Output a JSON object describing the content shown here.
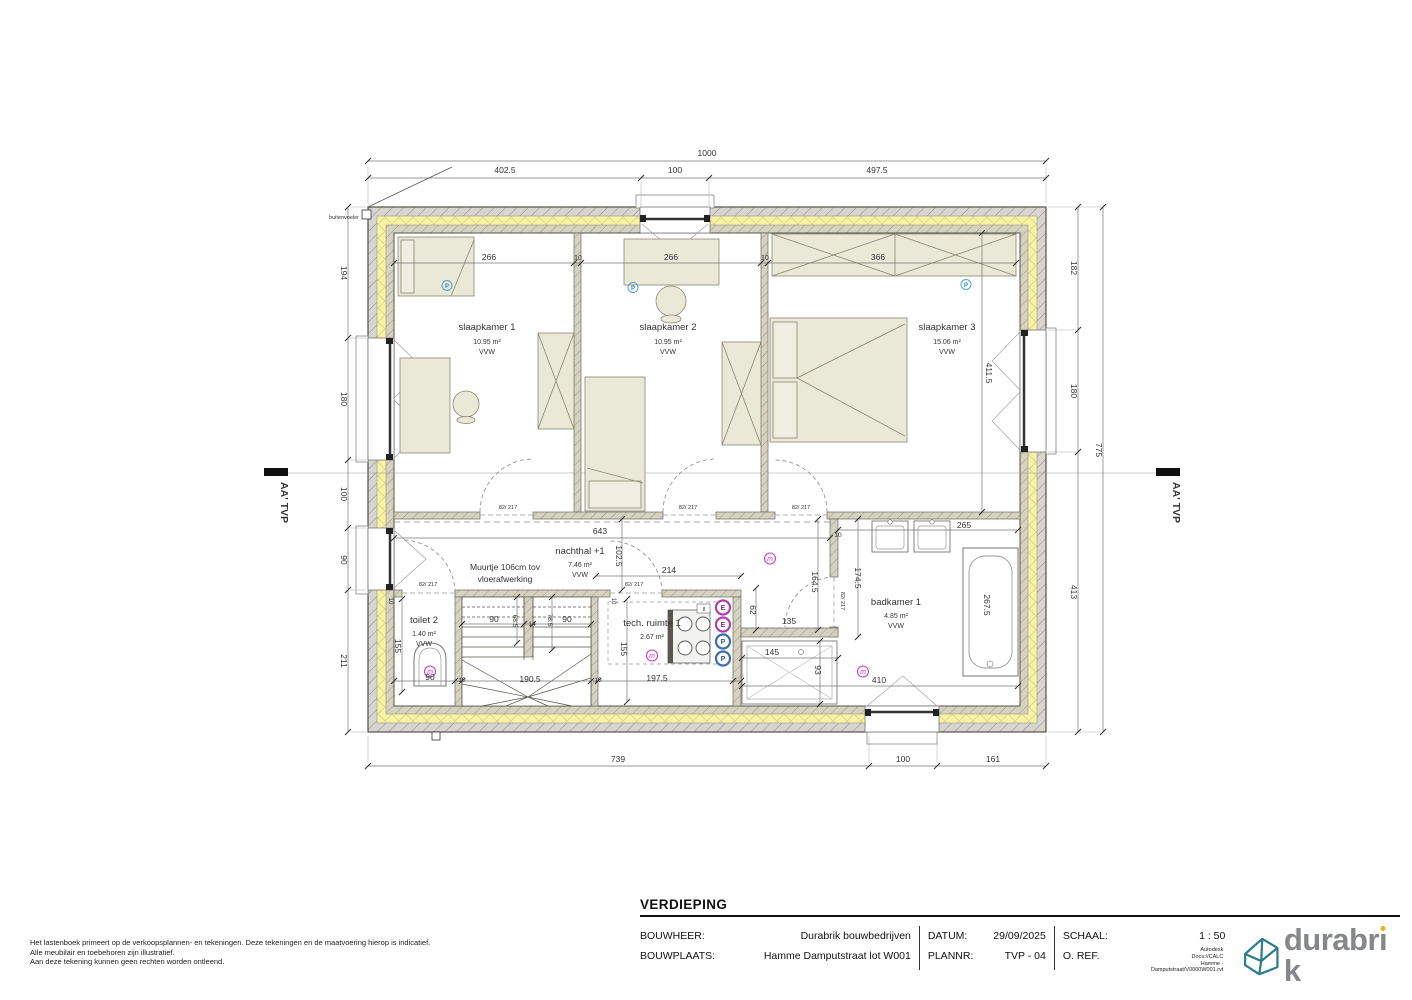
{
  "plan": {
    "labels": [
      {
        "t": "1000",
        "x": 707,
        "y": 156
      },
      {
        "t": "402.5",
        "x": 505,
        "y": 173
      },
      {
        "t": "100",
        "x": 675,
        "y": 173
      },
      {
        "t": "497.5",
        "x": 877,
        "y": 173
      },
      {
        "t": "194",
        "x": 341,
        "y": 273,
        "r": 90
      },
      {
        "t": "180",
        "x": 341,
        "y": 399,
        "r": 90
      },
      {
        "t": "100",
        "x": 341,
        "y": 494,
        "r": 90
      },
      {
        "t": "90",
        "x": 341,
        "y": 560,
        "r": 90
      },
      {
        "t": "211",
        "x": 341,
        "y": 661,
        "r": 90
      },
      {
        "t": "182",
        "x": 1071,
        "y": 268,
        "r": 90
      },
      {
        "t": "180",
        "x": 1071,
        "y": 391,
        "r": 90
      },
      {
        "t": "413",
        "x": 1071,
        "y": 592,
        "r": 90
      },
      {
        "t": "775",
        "x": 1096,
        "y": 450,
        "r": 90
      },
      {
        "t": "739",
        "x": 618,
        "y": 762
      },
      {
        "t": "100",
        "x": 903,
        "y": 762
      },
      {
        "t": "161",
        "x": 993,
        "y": 762
      },
      {
        "t": "buitenvoeler",
        "x": 359,
        "y": 219,
        "s": 5.5,
        "a": "end",
        "n": "sensor-label"
      },
      {
        "t": "266",
        "x": 489,
        "y": 260
      },
      {
        "t": "10",
        "x": 578,
        "y": 260,
        "s": 7
      },
      {
        "t": "266",
        "x": 671,
        "y": 260
      },
      {
        "t": "10",
        "x": 765,
        "y": 260,
        "s": 7
      },
      {
        "t": "366",
        "x": 878,
        "y": 260
      },
      {
        "t": "411.5",
        "x": 986,
        "y": 373,
        "r": 90
      },
      {
        "t": "643",
        "x": 600,
        "y": 534
      },
      {
        "t": "102.5",
        "x": 616,
        "y": 556,
        "r": 90
      },
      {
        "t": "214",
        "x": 669,
        "y": 573
      },
      {
        "t": "10",
        "x": 838,
        "y": 537,
        "s": 6.5
      },
      {
        "t": "174.5",
        "x": 855,
        "y": 578,
        "r": 90
      },
      {
        "t": "164.5",
        "x": 812,
        "y": 582,
        "r": 90
      },
      {
        "t": "62",
        "x": 750,
        "y": 610,
        "r": 90
      },
      {
        "t": "135",
        "x": 789,
        "y": 624
      },
      {
        "t": "145",
        "x": 772,
        "y": 655
      },
      {
        "t": "93",
        "x": 815,
        "y": 670,
        "r": 90
      },
      {
        "t": "410",
        "x": 879,
        "y": 683
      },
      {
        "t": "265",
        "x": 964,
        "y": 528
      },
      {
        "t": "267.5",
        "x": 984,
        "y": 605,
        "r": 90
      },
      {
        "t": "155",
        "x": 395,
        "y": 646,
        "r": 90
      },
      {
        "t": "90",
        "x": 430,
        "y": 680
      },
      {
        "t": "10",
        "x": 462,
        "y": 682,
        "s": 6.5
      },
      {
        "t": "190.5",
        "x": 530,
        "y": 682
      },
      {
        "t": "10",
        "x": 598,
        "y": 682,
        "s": 6.5
      },
      {
        "t": "197.5",
        "x": 657,
        "y": 681
      },
      {
        "t": "155",
        "x": 621,
        "y": 649,
        "r": 90
      },
      {
        "t": "90",
        "x": 494,
        "y": 622
      },
      {
        "t": "68.5",
        "x": 513,
        "y": 621,
        "r": 90,
        "s": 6.5
      },
      {
        "t": "14",
        "x": 532,
        "y": 626,
        "s": 6.5
      },
      {
        "t": "78.5",
        "x": 548,
        "y": 620,
        "r": 90,
        "s": 6.5
      },
      {
        "t": "90",
        "x": 567,
        "y": 622
      },
      {
        "t": "10",
        "x": 389,
        "y": 601,
        "r": 90,
        "s": 6
      },
      {
        "t": "10",
        "x": 612,
        "y": 601,
        "r": 90,
        "s": 6
      },
      {
        "t": "82/ 217",
        "x": 508,
        "y": 509,
        "s": 5.5,
        "n": "door-size-label"
      },
      {
        "t": "82/ 217",
        "x": 688,
        "y": 509,
        "s": 5.5,
        "n": "door-size-label"
      },
      {
        "t": "82/ 217",
        "x": 801,
        "y": 509,
        "s": 5.5,
        "n": "door-size-label"
      },
      {
        "t": "82/ 217",
        "x": 428,
        "y": 586,
        "s": 5.5,
        "n": "door-size-label"
      },
      {
        "t": "82/ 217",
        "x": 634,
        "y": 586,
        "s": 5.5,
        "n": "door-size-label"
      },
      {
        "t": "82/ 217",
        "x": 841,
        "y": 601,
        "r": 90,
        "s": 5.5,
        "n": "door-size-label"
      },
      {
        "t": "AA' TVP",
        "x": 281,
        "y": 482,
        "r": 90,
        "s": 10.5,
        "a": "start",
        "w": "bold",
        "n": "section-marker-label"
      },
      {
        "t": "AA' TVP",
        "x": 1173,
        "y": 482,
        "r": 90,
        "s": 10.5,
        "a": "start",
        "w": "bold",
        "n": "section-marker-label"
      },
      {
        "t": "slaapkamer 1",
        "x": 487,
        "y": 330,
        "s": 9.5,
        "n": "room-label"
      },
      {
        "t": "10.95 m²",
        "x": 487,
        "y": 344,
        "s": 7,
        "n": "room-area"
      },
      {
        "t": "VVW",
        "x": 487,
        "y": 354,
        "s": 7,
        "n": "room-floor"
      },
      {
        "t": "slaapkamer 2",
        "x": 668,
        "y": 330,
        "s": 9.5,
        "n": "room-label"
      },
      {
        "t": "10.95 m²",
        "x": 668,
        "y": 344,
        "s": 7,
        "n": "room-area"
      },
      {
        "t": "VVW",
        "x": 668,
        "y": 354,
        "s": 7,
        "n": "room-floor"
      },
      {
        "t": "slaapkamer 3",
        "x": 947,
        "y": 330,
        "s": 9.5,
        "n": "room-label"
      },
      {
        "t": "15.06 m²",
        "x": 947,
        "y": 344,
        "s": 7,
        "n": "room-area"
      },
      {
        "t": "VVW",
        "x": 947,
        "y": 354,
        "s": 7,
        "n": "room-floor"
      },
      {
        "t": "nachthal +1",
        "x": 580,
        "y": 554,
        "s": 9.5,
        "n": "room-label"
      },
      {
        "t": "7.46 m²",
        "x": 580,
        "y": 567,
        "s": 7,
        "n": "room-area"
      },
      {
        "t": "VVW",
        "x": 580,
        "y": 577,
        "s": 7,
        "n": "room-floor"
      },
      {
        "t": "Muurtje 106cm tov",
        "x": 505,
        "y": 570,
        "s": 8.5,
        "n": "note-label"
      },
      {
        "t": "vloerafwerking",
        "x": 505,
        "y": 582,
        "s": 8.5,
        "n": "note-label"
      },
      {
        "t": "toilet 2",
        "x": 424,
        "y": 623,
        "s": 9.5,
        "n": "room-label"
      },
      {
        "t": "1.40 m²",
        "x": 424,
        "y": 636,
        "s": 7,
        "n": "room-area"
      },
      {
        "t": "VVW",
        "x": 424,
        "y": 646,
        "s": 7,
        "n": "room-floor"
      },
      {
        "t": "tech. ruimte 1",
        "x": 652,
        "y": 626,
        "s": 9.5,
        "n": "room-label"
      },
      {
        "t": "2.67 m²",
        "x": 652,
        "y": 639,
        "s": 7,
        "n": "room-area"
      },
      {
        "t": "badkamer 1",
        "x": 896,
        "y": 605,
        "s": 9.5,
        "n": "room-label"
      },
      {
        "t": "4.85 m²",
        "x": 896,
        "y": 618,
        "s": 7,
        "n": "room-area"
      },
      {
        "t": "VVW",
        "x": 896,
        "y": 628,
        "s": 7,
        "n": "room-floor"
      },
      {
        "t": "m",
        "x": 430,
        "y": 674,
        "s": 7,
        "c": "#cf3ccf",
        "i": true,
        "n": "switch-symbol-letter"
      },
      {
        "t": "m",
        "x": 652,
        "y": 658,
        "s": 7,
        "c": "#cf3ccf",
        "i": true,
        "n": "switch-symbol-letter"
      },
      {
        "t": "m",
        "x": 770,
        "y": 561,
        "s": 7,
        "c": "#cf3ccf",
        "i": true,
        "n": "switch-symbol-letter"
      },
      {
        "t": "m",
        "x": 863,
        "y": 674,
        "s": 7,
        "c": "#cf3ccf",
        "i": true,
        "n": "switch-symbol-letter"
      },
      {
        "t": "P",
        "x": 447,
        "y": 288,
        "s": 6,
        "c": "#2e86c8",
        "w": "bold",
        "n": "outlet-symbol-letter"
      },
      {
        "t": "P",
        "x": 633,
        "y": 290,
        "s": 6,
        "c": "#2e86c8",
        "w": "bold",
        "n": "outlet-symbol-letter"
      },
      {
        "t": "P",
        "x": 966,
        "y": 287,
        "s": 6,
        "c": "#2e86c8",
        "w": "bold",
        "n": "outlet-symbol-letter"
      },
      {
        "t": "E",
        "x": 723,
        "y": 610,
        "s": 7,
        "c": "#8a2d8a",
        "w": "bold",
        "n": "panel-symbol-letter"
      },
      {
        "t": "E",
        "x": 723,
        "y": 627,
        "s": 7,
        "c": "#8a2d8a",
        "w": "bold",
        "n": "panel-symbol-letter"
      },
      {
        "t": "P",
        "x": 723,
        "y": 644,
        "s": 7,
        "c": "#2d5c94",
        "w": "bold",
        "n": "panel-symbol-letter"
      },
      {
        "t": "P",
        "x": 723,
        "y": 661,
        "s": 7,
        "c": "#2d5c94",
        "w": "bold",
        "n": "panel-symbol-letter"
      },
      {
        "t": "8",
        "x": 704,
        "y": 611,
        "s": 5,
        "n": "appliance-label"
      }
    ]
  },
  "disclaimer": {
    "line1": "Het lastenboek primeert op de verkoopsplannen- en tekeningen. Deze tekeningen en de maatvoering hierop is indicatief.",
    "line2": "Alle meubilair en toebehoren zijn illustratief.",
    "line3": "Aan deze tekening kunnen geen rechten worden ontleend."
  },
  "titleblock": {
    "section_title": "VERDIEPING",
    "rows": {
      "bouwheer_label": "BOUWHEER:",
      "bouwheer_value": "Durabrik bouwbedrijven",
      "bouwplaats_label": "BOUWPLAATS:",
      "bouwplaats_value": "Hamme Damputstraat lot W001",
      "datum_label": "DATUM:",
      "datum_value": "29/09/2025",
      "plannr_label": "PLANNR:",
      "plannr_value": "TVP - 04",
      "schaal_label": "SCHAAL:",
      "schaal_value": "1 : 50",
      "oref_label": "O. REF."
    },
    "file_ref": {
      "line1": "Autodesk",
      "line2": "Docs://CALC",
      "line3": "Hamme -",
      "line4": "Damputstraat/V0000W001.rvt"
    },
    "logo_text": "durabrik",
    "logo_part1": "durabr",
    "logo_i": "ı",
    "logo_part2": "k"
  },
  "colors": {
    "insulation_yellow": "#f7f3a3",
    "wall_gray": "#d8d5d0",
    "wall_inner_beige": "#d6d2c0",
    "furniture": "#eae8d6",
    "switch_magenta": "#cf3ccf",
    "outlet_blue": "#2e86c8",
    "logo_teal": "#2c7d8c",
    "logo_gray": "#85878a",
    "logo_dot_yellow": "#e7b50e"
  }
}
